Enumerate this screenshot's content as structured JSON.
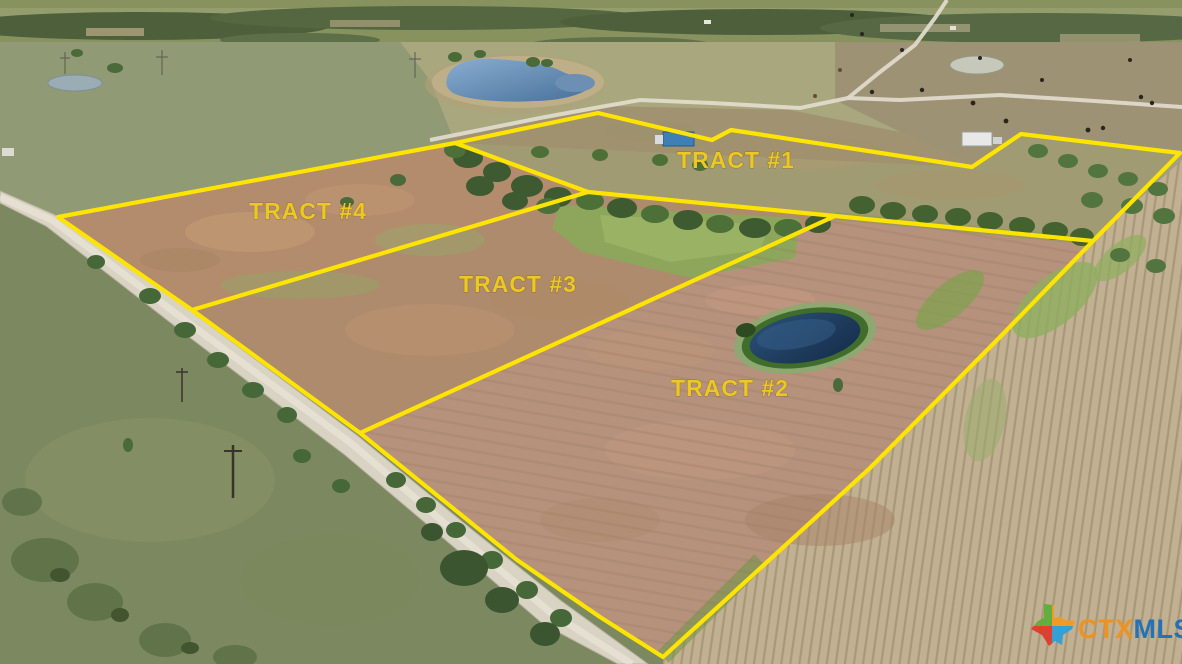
{
  "photo": {
    "description": "Aerial drone photo of rural farmland subdivided into four marked tracts along a gravel road",
    "width": 1182,
    "height": 664
  },
  "overlay": {
    "line_color": "#ffe400",
    "label_color": "#edc823",
    "tracts": [
      {
        "id": "tract-1",
        "label": "TRACT #1"
      },
      {
        "id": "tract-2",
        "label": "TRACT #2"
      },
      {
        "id": "tract-3",
        "label": "TRACT #3"
      },
      {
        "id": "tract-4",
        "label": "TRACT #4"
      }
    ]
  },
  "watermark": {
    "icon": "texas-state-icon",
    "prefix": "CTX",
    "suffix": "MLS",
    "prefix_color": "#f0921e",
    "suffix_color": "#1d6fb8",
    "icon_colors": {
      "green": "#5fae3a",
      "orange": "#f39a1e",
      "red": "#dd3d2d",
      "blue": "#2da0d8"
    }
  },
  "scene_palette": {
    "plowed_field_brown": "#b18c6e",
    "pasture_green": "#8e9873",
    "harvested_field_tan": "#c1b091",
    "road_gravel": "#d9d3c3",
    "pond_water_dark": "#1f3c5e",
    "pond_water_light": "#6e94bb",
    "tree_green": "#466737"
  }
}
